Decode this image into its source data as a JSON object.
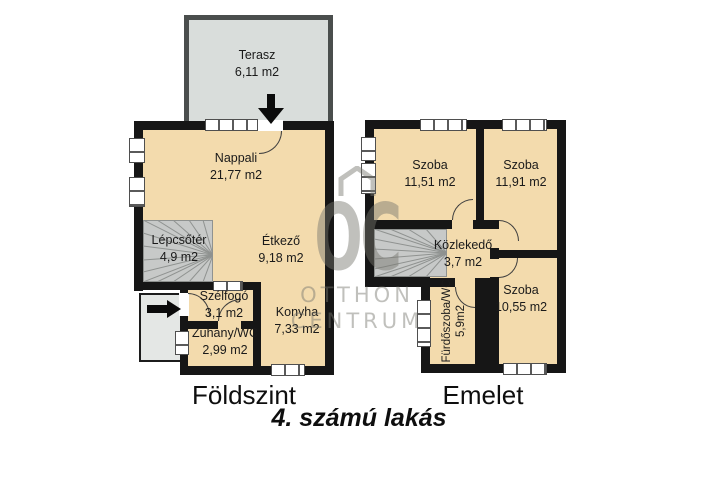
{
  "title": "4. számú lakás",
  "watermark": {
    "monogram": "OC",
    "line1": "OTTHON",
    "line2": "CENTRUM"
  },
  "ground_floor": {
    "caption": "Földszint",
    "rooms": [
      {
        "name": "Terasz",
        "area": "6,11 m2"
      },
      {
        "name": "Nappali",
        "area": "21,77 m2"
      },
      {
        "name": "Lépcsőtér",
        "area": "4,9 m2"
      },
      {
        "name": "Étkező",
        "area": "9,18 m2"
      },
      {
        "name": "Szélfogó",
        "area": "3,1 m2"
      },
      {
        "name": "Zuhany/WC",
        "area": "2,99 m2"
      },
      {
        "name": "Konyha",
        "area": "7,33 m2"
      }
    ]
  },
  "upper_floor": {
    "caption": "Emelet",
    "rooms": [
      {
        "name": "Szoba",
        "area": "11,51 m2"
      },
      {
        "name": "Szoba",
        "area": "11,91 m2"
      },
      {
        "name": "Közlekedő",
        "area": "3,7 m2"
      },
      {
        "name": "Szoba",
        "area": "10,55 m2"
      },
      {
        "name": "Fürdőszoba/WC",
        "area": "5,9m2"
      }
    ]
  },
  "colors": {
    "wall": "#161616",
    "room": "#f3dbad",
    "stair": "#c7c9c8",
    "stairline": "#8f9290",
    "terrace": "#d9dddb",
    "terraceborder": "#4a4e4d",
    "porch": "#e4e7e5",
    "winframe": "#4f4f4f",
    "winline": "#5a5a5a",
    "door": "#3f3f3f",
    "ink": "#1a1a1a",
    "watermark": "#75756d"
  }
}
